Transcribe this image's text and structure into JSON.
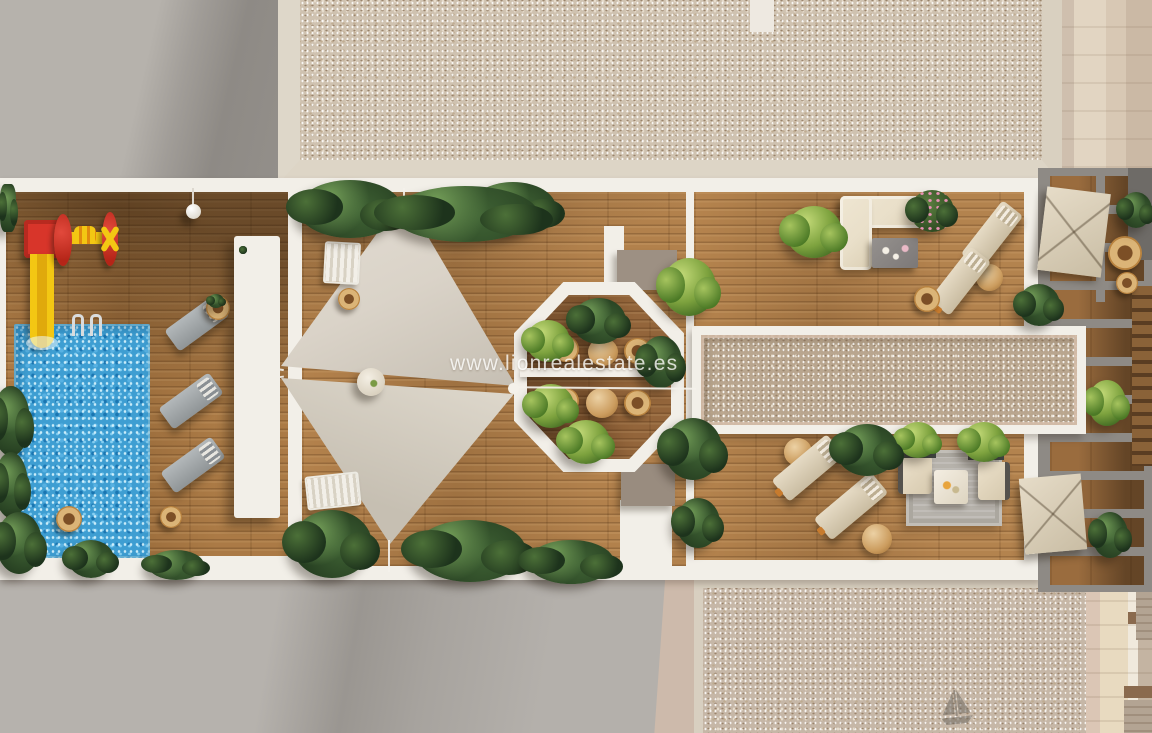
{
  "watermark": {
    "text": "www.lionrealestate.es"
  },
  "palette": {
    "white_deck": "#f2efe8",
    "wood": "#a4733f",
    "wood_dark": "#8a5c33",
    "pool_blue": "#3e9ed2",
    "gravel_light": "#cfc2b0",
    "gravel_dark": "#b9a68f",
    "roof_gray": "#b3afaa",
    "sail": "#dad3c8",
    "plant_dark": "#22391e",
    "plant_light": "#7da23e",
    "play_red": "#d8352a",
    "play_yellow": "#f3c713",
    "cream": "#e9dfc9",
    "lounger_gray": "#9fa5a8",
    "taupe": "#9d9083",
    "wall_beige": "#e2d5c2",
    "watermark_white": "#fcfcfa"
  }
}
